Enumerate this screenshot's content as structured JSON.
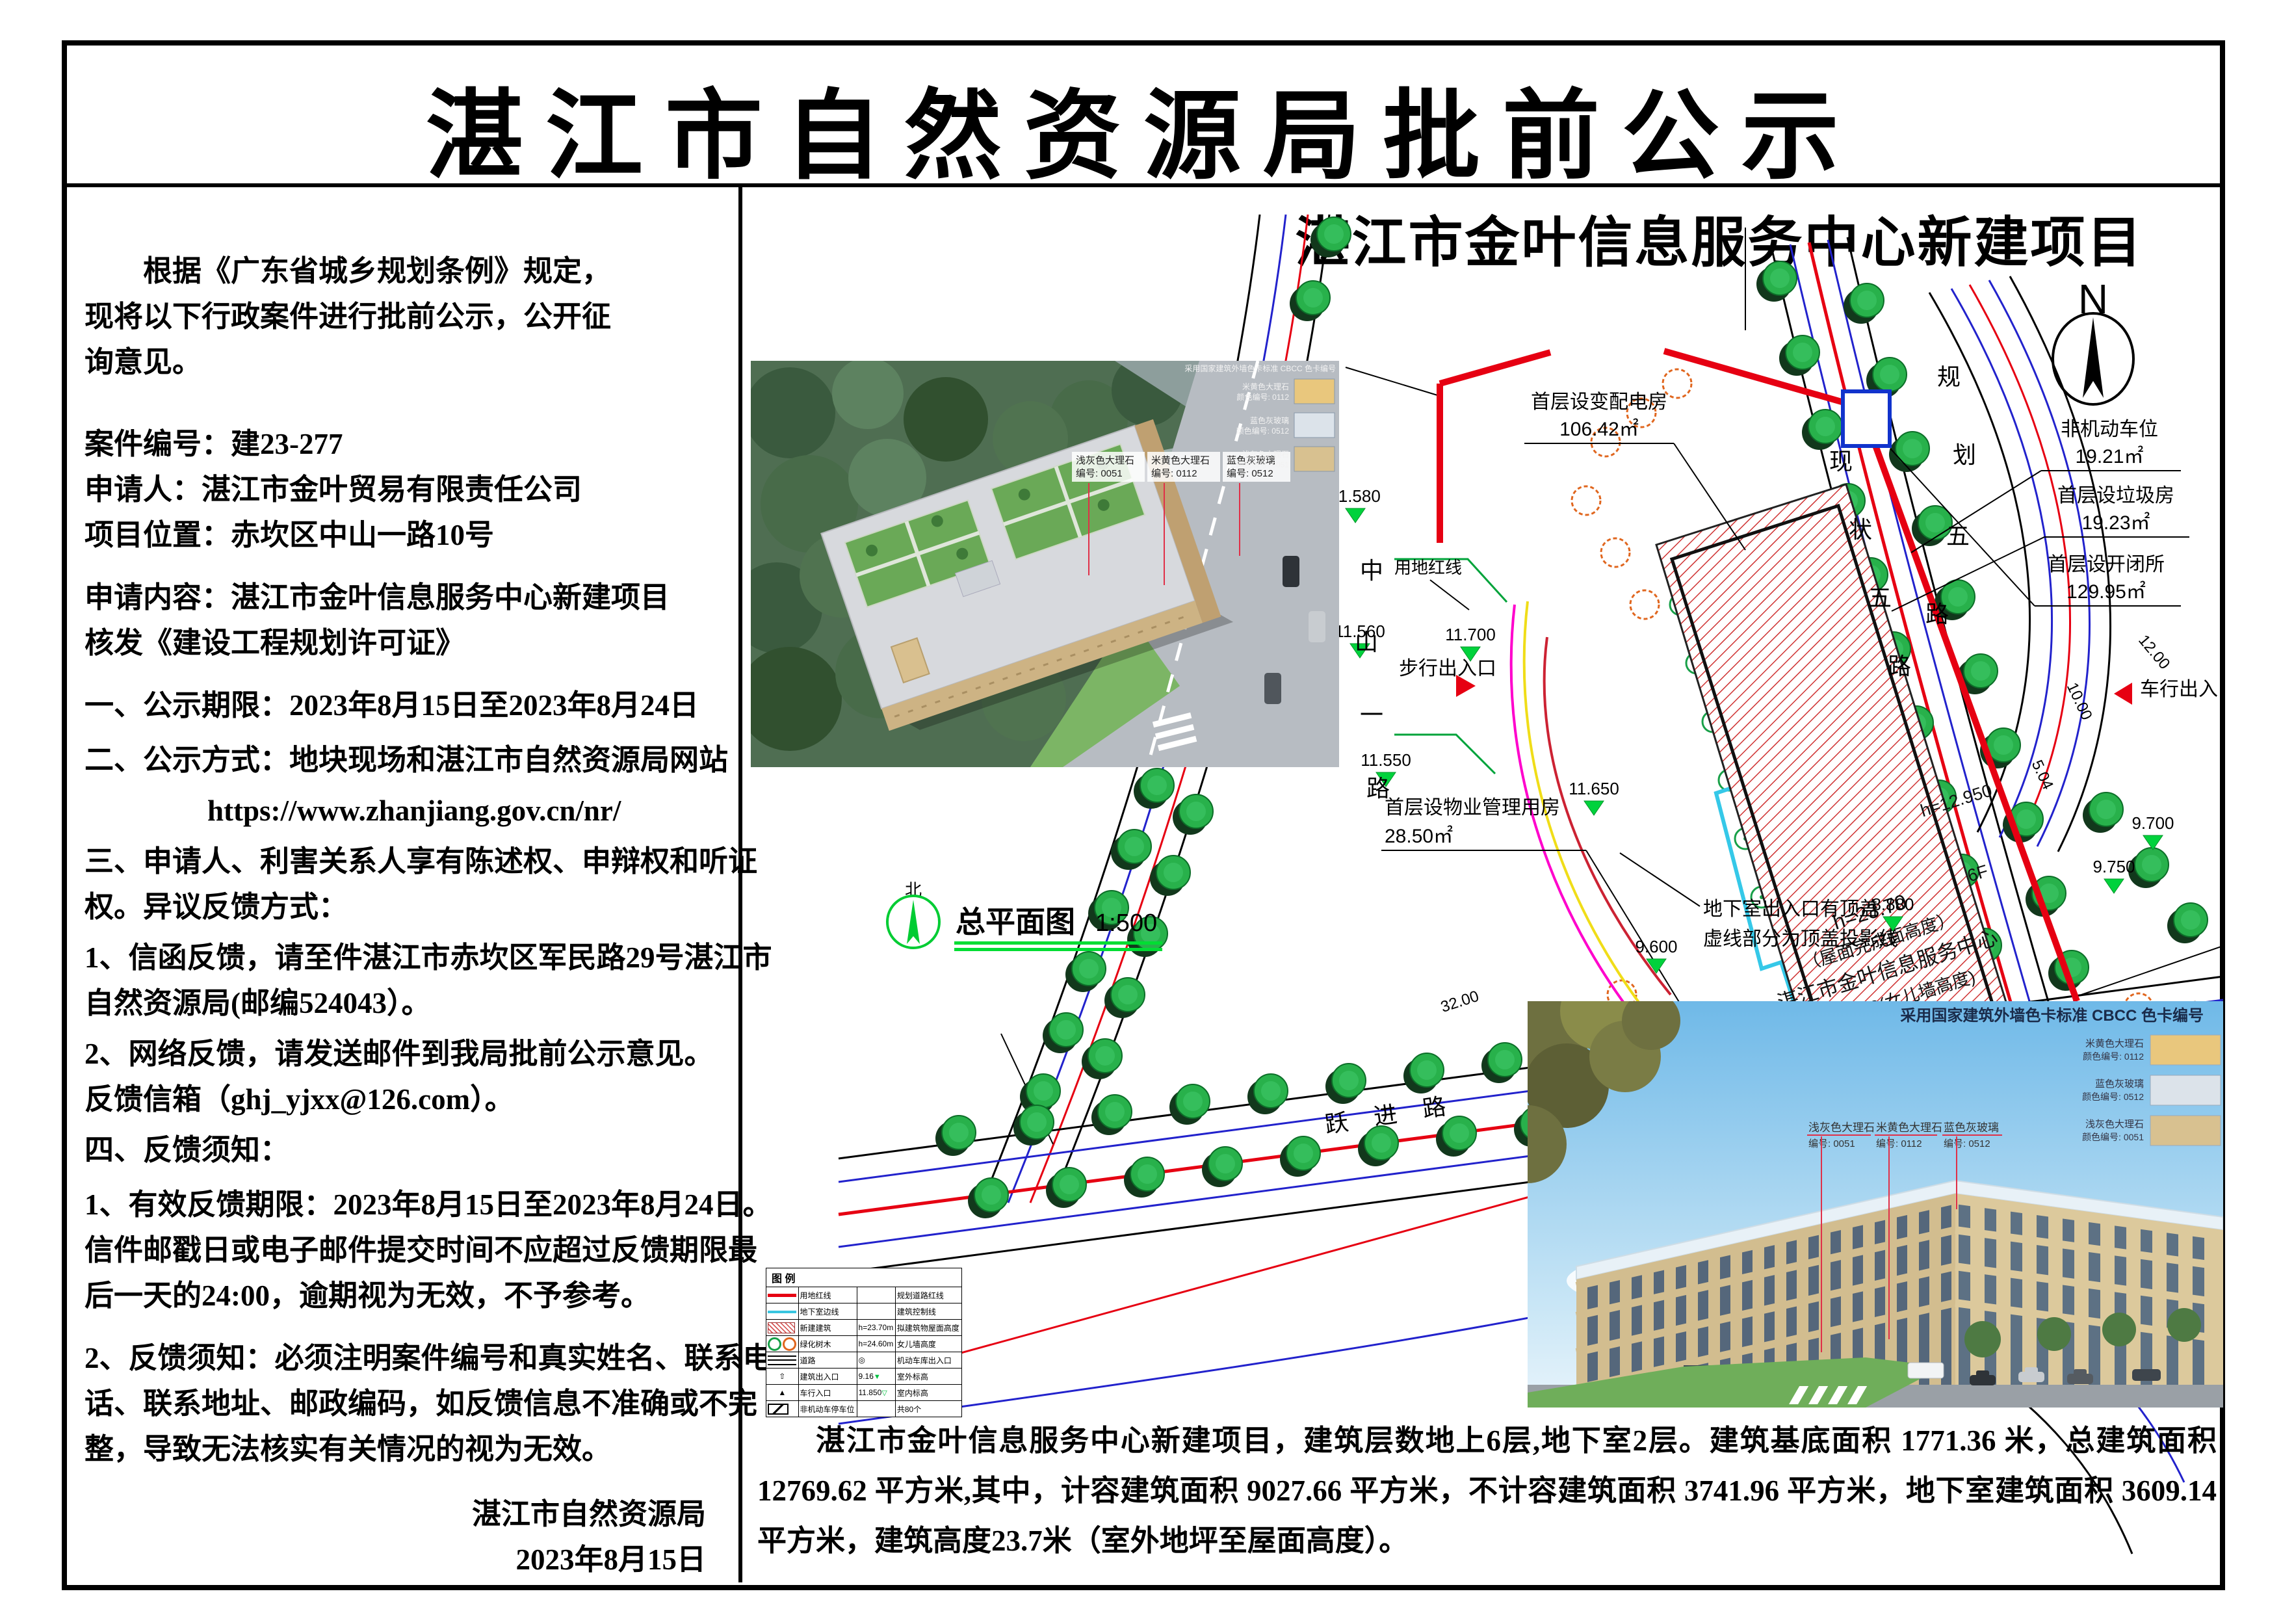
{
  "header": {
    "title": "湛江市自然资源局批前公示"
  },
  "notice": {
    "lines": [
      "根据《广东省城乡规划条例》规定，",
      "现将以下行政案件进行批前公示，公开征",
      "询意见。",
      "案件编号：建23-277",
      "申请人：湛江市金叶贸易有限责任公司",
      "项目位置：赤坎区中山一路10号",
      "申请内容：湛江市金叶信息服务中心新建项目",
      "核发《建设工程规划许可证》",
      "一、公示期限：2023年8月15日至2023年8月24日",
      "二、公示方式：地块现场和湛江市自然资源局网站",
      "https://www.zhanjiang.gov.cn/nr/",
      "三、申请人、利害关系人享有陈述权、申辩权和听证",
      "权。异议反馈方式：",
      "1、信函反馈，请至件湛江市赤坎区军民路29号湛江市",
      "自然资源局(邮编524043）。",
      "2、网络反馈，请发送邮件到我局批前公示意见。",
      "反馈信箱（ghj_yjxx@126.com）。",
      "四、反馈须知：",
      "1、有效反馈期限：2023年8月15日至2023年8月24日。",
      "信件邮戳日或电子邮件提交时间不应超过反馈期限最",
      "后一天的24:00，逾期视为无效，不予参考。",
      "2、反馈须知：必须注明案件编号和真实姓名、联系电",
      "话、联系地址、邮政编码，如反馈信息不准确或不完",
      "整，导致无法核实有关情况的视为无效。",
      "湛江市自然资源局",
      "2023年8月15日"
    ]
  },
  "plan": {
    "title": "湛江市金叶信息服务中心新建项目",
    "north": "N",
    "north_cn": "北",
    "drawing_label": "总平面图",
    "drawing_scale": "1:500",
    "roads": {
      "zhongshan": "中山一路",
      "yuejin": "跃进路",
      "xianzhuang": "现状五路",
      "guihua": "规划五路"
    },
    "callouts": {
      "transformer": {
        "label": "首层设变配电房",
        "area": "106.42㎡"
      },
      "nonmotor": {
        "label": "非机动车位",
        "area": "19.21㎡"
      },
      "garbage": {
        "label": "首层设垃圾房",
        "area": "19.23㎡"
      },
      "switchroom": {
        "label": "首层设开闭所",
        "area": "129.95㎡"
      },
      "property": {
        "label": "首层设物业管理用房",
        "area": "28.50㎡"
      },
      "basement_note1": "地下室出入口有顶盖",
      "basement_note2": "虚线部分为顶盖投影线",
      "bike_park": "公共自行车停车场",
      "walk_entrance": "步行出入口",
      "car_entrance": "车行出入口",
      "red_line": "用地红线",
      "area_box": "面积: 126.12㎡",
      "parking_note": "10.850（非机动车停车场）"
    },
    "building": {
      "name": "湛江市金叶信息服务中心",
      "height_roof": "h=23.70",
      "height_roof_note": "（屋面完成面高度）",
      "height_parapet": "h=24.60(女儿墙高度)",
      "height_wing": "h=12.950",
      "floors": "6F",
      "ground_elev": "11.850",
      "zero_elev": "±0.000"
    },
    "elevations": {
      "e1": "11.580",
      "e2": "11.560",
      "e3": "11.550",
      "e4": "11.700",
      "e5": "11.650",
      "e6": "10.850",
      "e7": "9.600",
      "e8": "9.500",
      "e9": "9.160",
      "e10": "8.880",
      "e11": "9.700",
      "e12": "9.750",
      "e13": "9.340",
      "e14": "9.800",
      "e15": "9.400"
    },
    "dims": {
      "d1": "12.00",
      "d2": "13.00",
      "d3": "32.00",
      "d4": "10.00",
      "d5": "5.04"
    }
  },
  "legend": {
    "title": "图 例",
    "rows": [
      {
        "c2": "用地红线",
        "c3": "",
        "c4": "规划道路红线"
      },
      {
        "c2": "地下室边线",
        "c3": "",
        "c4": "建筑控制线"
      },
      {
        "c2": "新建建筑",
        "c3": "h=23.70m",
        "c4": "拟建筑物屋面高度"
      },
      {
        "c2": "绿化树木",
        "c3": "h=24.60m",
        "c4": "女儿墙高度"
      },
      {
        "c2": "道路",
        "c3": "",
        "c4": "机动车库出入口"
      },
      {
        "c2": "建筑出入口",
        "c3": "9.16",
        "c4": "室外标高"
      },
      {
        "c2": "车行入口",
        "c3": "11.850",
        "c4": "室内标高"
      },
      {
        "c2": "非机动车停车位",
        "c3": "",
        "c4": "共80个"
      }
    ]
  },
  "render": {
    "header": "采用国家建筑外墙色卡标准 CBCC 色卡编号",
    "swatches": [
      {
        "name": "米黄色大理石",
        "code": "颜色编号: 0112",
        "color": "#e9c77d"
      },
      {
        "name": "蓝色灰玻璃",
        "code": "颜色编号: 0512",
        "color": "#dce3ea"
      },
      {
        "name": "浅灰色大理石",
        "code": "颜色编号: 0051",
        "color": "#d8c190"
      }
    ],
    "callouts": [
      {
        "name": "浅灰色大理石",
        "code": "编号: 0051"
      },
      {
        "name": "米黄色大理石",
        "code": "编号: 0112"
      },
      {
        "name": "蓝色灰玻璃",
        "code": "编号: 0512"
      }
    ]
  },
  "footer": {
    "text": "湛江市金叶信息服务中心新建项目，建筑层数地上6层,地下室2层。建筑基底面积 1771.36 米，总建筑面积 12769.62 平方米,其中，计容建筑面积 9027.66 平方米，不计容建筑面积 3741.96 平方米，地下室建筑面积 3609.14 平方米，建筑高度23.7米（室外地坪至屋面高度）。"
  }
}
